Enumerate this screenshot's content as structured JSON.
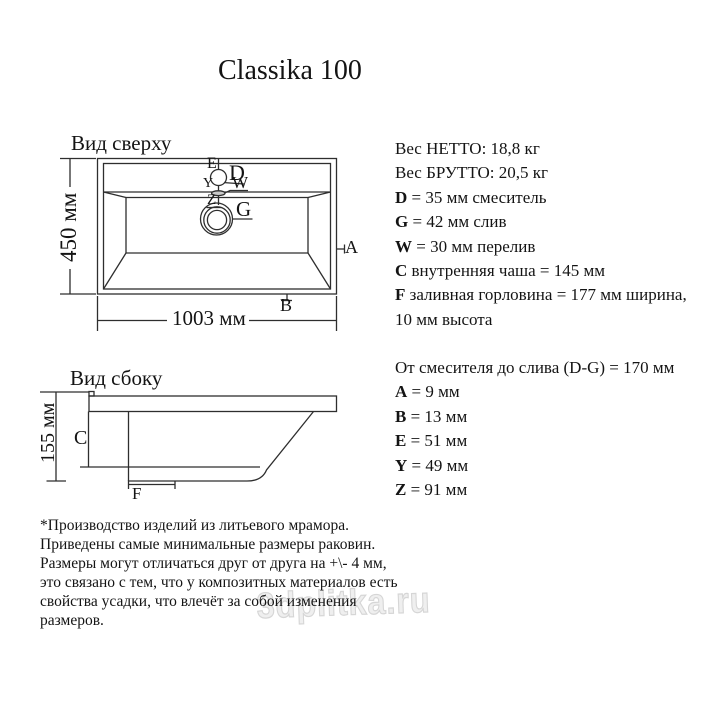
{
  "title": "Classika 100",
  "watermark_text": "3dplitka.ru",
  "top_view": {
    "label": "Вид сверху",
    "height_dim": "450 мм",
    "width_dim": "1003 мм",
    "marker_e": "E",
    "marker_d": "D",
    "marker_y": "Y",
    "marker_w": "W",
    "marker_z": "Z",
    "marker_g": "G",
    "marker_a": "A",
    "marker_b": "B"
  },
  "side_view": {
    "label": "Вид сбоку",
    "height_dim": "155 мм",
    "marker_c": "C",
    "marker_f": "F"
  },
  "specs_block1": [
    {
      "b": "",
      "t": "Вес НЕТТО: 18,8 кг"
    },
    {
      "b": "",
      "t": "Вес БРУТТО: 20,5 кг"
    },
    {
      "b": "D",
      "t": " = 35 мм смеситель"
    },
    {
      "b": "G",
      "t": " = 42 мм слив"
    },
    {
      "b": "W",
      "t": " = 30 мм перелив"
    },
    {
      "b": "C",
      "t": " внутренняя чаша = 145 мм"
    },
    {
      "b": "F",
      "t": " заливная горловина = 177 мм ширина,"
    },
    {
      "b": "",
      "t": "10 мм высота"
    }
  ],
  "specs_block2": [
    {
      "b": "",
      "t": "От смесителя до слива (D-G) = 170 мм"
    },
    {
      "b": "A",
      "t": " = 9 мм"
    },
    {
      "b": "B",
      "t": " = 13 мм"
    },
    {
      "b": "E",
      "t": " = 51 мм"
    },
    {
      "b": "Y",
      "t": " = 49 мм"
    },
    {
      "b": "Z",
      "t": " = 91 мм"
    }
  ],
  "footnote": [
    "*Производство изделий из литьевого мрамора.",
    "Приведены самые минимальные размеры раковин.",
    "Размеры могут отличаться друг от друга на +\\- 4 мм,",
    "это связано с тем, что у композитных материалов есть",
    "свойства усадки, что влечёт за собой изменения",
    "размеров."
  ],
  "colors": {
    "line": "#2e2e2e",
    "text": "#141414",
    "watermark": "#d6d6d6"
  }
}
